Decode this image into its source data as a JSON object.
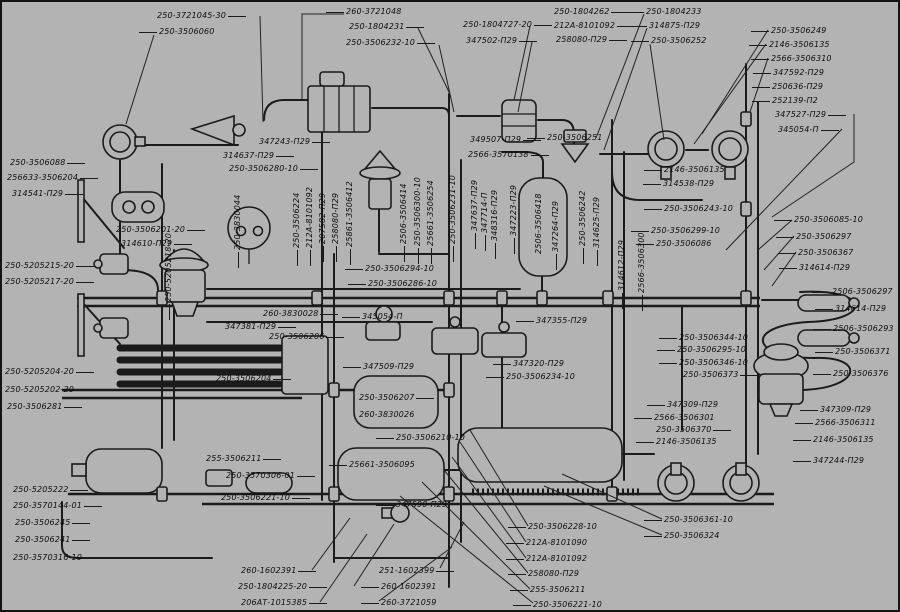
{
  "diagram": {
    "type": "pneumatic-brake-system-schematic",
    "background_color": "#b3b3b3",
    "line_color": "#1b1b1b",
    "label_color": "#0d0d0d"
  },
  "labels": [
    {
      "t": "250-3721045-30",
      "x": 155,
      "y": 9,
      "lead": "r"
    },
    {
      "t": "250-3506060",
      "x": 157,
      "y": 25,
      "lead": "l"
    },
    {
      "t": "260-3721048",
      "x": 344,
      "y": 5,
      "lead": "l"
    },
    {
      "t": "250-1804231",
      "x": 347,
      "y": 20,
      "lead": "r"
    },
    {
      "t": "250-3506232-10",
      "x": 344,
      "y": 36,
      "lead": "r"
    },
    {
      "t": "250-1804727-20",
      "x": 461,
      "y": 18,
      "lead": "r"
    },
    {
      "t": "347502-П29",
      "x": 464,
      "y": 34,
      "lead": "r"
    },
    {
      "t": "250-1804262",
      "x": 552,
      "y": 5,
      "lead": "r"
    },
    {
      "t": "212А-8101092",
      "x": 552,
      "y": 19,
      "lead": "r"
    },
    {
      "t": "258080-П29",
      "x": 554,
      "y": 33,
      "lead": "r"
    },
    {
      "t": "250-1804233",
      "x": 644,
      "y": 5,
      "lead": "l"
    },
    {
      "t": "314875-П29",
      "x": 647,
      "y": 19,
      "lead": "l"
    },
    {
      "t": "250-3506252",
      "x": 649,
      "y": 34,
      "lead": "l"
    },
    {
      "t": "250-3506249",
      "x": 769,
      "y": 24,
      "lead": "l"
    },
    {
      "t": "2146-3506135",
      "x": 767,
      "y": 38,
      "lead": "l"
    },
    {
      "t": "2566-3506310",
      "x": 769,
      "y": 52,
      "lead": "l"
    },
    {
      "t": "347592-П29",
      "x": 771,
      "y": 66,
      "lead": "l"
    },
    {
      "t": "250636-П29",
      "x": 770,
      "y": 80,
      "lead": "l"
    },
    {
      "t": "252139-П2",
      "x": 770,
      "y": 94,
      "lead": "l"
    },
    {
      "t": "347527-П29",
      "x": 773,
      "y": 108,
      "lead": "r"
    },
    {
      "t": "345054-П",
      "x": 776,
      "y": 123,
      "lead": "r"
    },
    {
      "t": "250-3506088",
      "x": 8,
      "y": 156,
      "lead": "r"
    },
    {
      "t": "256633-3506204",
      "x": 5,
      "y": 171,
      "lead": "r"
    },
    {
      "t": "314541-П29",
      "x": 10,
      "y": 187,
      "lead": "r"
    },
    {
      "t": "250-3506201-20",
      "x": 114,
      "y": 223,
      "lead": "r"
    },
    {
      "t": "314610-П29",
      "x": 119,
      "y": 237,
      "lead": "r"
    },
    {
      "t": "250-5205215-20",
      "x": 3,
      "y": 259,
      "lead": "r"
    },
    {
      "t": "250-5205217-20",
      "x": 3,
      "y": 275,
      "lead": "r"
    },
    {
      "t": "250-5205204-20",
      "x": 3,
      "y": 365,
      "lead": "r"
    },
    {
      "t": "250-5205202-20",
      "x": 3,
      "y": 383,
      "lead": "r"
    },
    {
      "t": "250-3506281",
      "x": 5,
      "y": 400,
      "lead": "r"
    },
    {
      "t": "250-5205222",
      "x": 11,
      "y": 483,
      "lead": "r"
    },
    {
      "t": "250-3570144-01",
      "x": 11,
      "y": 499,
      "lead": "r"
    },
    {
      "t": "250-3506245",
      "x": 13,
      "y": 516,
      "lead": "r"
    },
    {
      "t": "250-3506241",
      "x": 13,
      "y": 533,
      "lead": "r"
    },
    {
      "t": "250-3570316-10",
      "x": 11,
      "y": 551,
      "lead": "r"
    },
    {
      "t": "347243-П29",
      "x": 257,
      "y": 135,
      "lead": "r"
    },
    {
      "t": "314637-П29",
      "x": 221,
      "y": 149,
      "lead": "r"
    },
    {
      "t": "250-3506280-10",
      "x": 227,
      "y": 162,
      "lead": "r"
    },
    {
      "t": "349507-П29",
      "x": 468,
      "y": 133,
      "lead": "r"
    },
    {
      "t": "2566-3570138",
      "x": 466,
      "y": 148,
      "lead": "r"
    },
    {
      "t": "250-3506251",
      "x": 545,
      "y": 131,
      "lead": "l"
    },
    {
      "t": "250-3506294-10",
      "x": 363,
      "y": 262,
      "lead": "l"
    },
    {
      "t": "250-3506286-10",
      "x": 366,
      "y": 277,
      "lead": "l"
    },
    {
      "t": "260-3830028",
      "x": 261,
      "y": 307,
      "lead": "r"
    },
    {
      "t": "347381-П29",
      "x": 223,
      "y": 320,
      "lead": "r"
    },
    {
      "t": "250-3506206",
      "x": 267,
      "y": 330,
      "lead": "r"
    },
    {
      "t": "250-3506204",
      "x": 214,
      "y": 372,
      "lead": "r"
    },
    {
      "t": "345054-П",
      "x": 360,
      "y": 310,
      "lead": "l"
    },
    {
      "t": "347509-П29",
      "x": 361,
      "y": 360,
      "lead": "l"
    },
    {
      "t": "250-3506207",
      "x": 357,
      "y": 391,
      "lead": "r"
    },
    {
      "t": "260-3830026",
      "x": 357,
      "y": 408,
      "lead": "n"
    },
    {
      "t": "250-3506210-10",
      "x": 394,
      "y": 431,
      "lead": "l"
    },
    {
      "t": "347355-П29",
      "x": 534,
      "y": 314,
      "lead": "l"
    },
    {
      "t": "347320-П29",
      "x": 511,
      "y": 357,
      "lead": "l"
    },
    {
      "t": "250-3506234-10",
      "x": 504,
      "y": 370,
      "lead": "l"
    },
    {
      "t": "2146-3506135",
      "x": 662,
      "y": 163,
      "lead": "l"
    },
    {
      "t": "314538-П29",
      "x": 661,
      "y": 177,
      "lead": "l"
    },
    {
      "t": "250-3506243-10",
      "x": 662,
      "y": 202,
      "lead": "l"
    },
    {
      "t": "250-3506299-10",
      "x": 649,
      "y": 224,
      "lead": "l"
    },
    {
      "t": "250-3506086",
      "x": 654,
      "y": 237,
      "lead": "l"
    },
    {
      "t": "250-3506085-10",
      "x": 792,
      "y": 213,
      "lead": "l"
    },
    {
      "t": "250-3506297",
      "x": 794,
      "y": 230,
      "lead": "l"
    },
    {
      "t": "250-3506367",
      "x": 796,
      "y": 246,
      "lead": "l"
    },
    {
      "t": "314614-П29",
      "x": 797,
      "y": 261,
      "lead": "l"
    },
    {
      "t": "2506-3506297",
      "x": 830,
      "y": 285,
      "lead": "l"
    },
    {
      "t": "314614-П29",
      "x": 833,
      "y": 302,
      "lead": "l"
    },
    {
      "t": "2506-3506293",
      "x": 831,
      "y": 322,
      "lead": "l"
    },
    {
      "t": "250-3506371",
      "x": 833,
      "y": 345,
      "lead": "l"
    },
    {
      "t": "250-3506376",
      "x": 831,
      "y": 367,
      "lead": "l"
    },
    {
      "t": "347309-П29",
      "x": 818,
      "y": 403,
      "lead": "l"
    },
    {
      "t": "2566-3506311",
      "x": 813,
      "y": 416,
      "lead": "l"
    },
    {
      "t": "2146-3506135",
      "x": 811,
      "y": 433,
      "lead": "l"
    },
    {
      "t": "347244-П29",
      "x": 811,
      "y": 454,
      "lead": "l"
    },
    {
      "t": "250-3506344-10",
      "x": 677,
      "y": 331,
      "lead": "l"
    },
    {
      "t": "250-3506295-10",
      "x": 675,
      "y": 343,
      "lead": "l"
    },
    {
      "t": "250-3506346-10",
      "x": 677,
      "y": 356,
      "lead": "l"
    },
    {
      "t": "250-3506373",
      "x": 681,
      "y": 368,
      "lead": "r"
    },
    {
      "t": "347309-П29",
      "x": 665,
      "y": 398,
      "lead": "l"
    },
    {
      "t": "2566-3506301",
      "x": 652,
      "y": 411,
      "lead": "l"
    },
    {
      "t": "250-3506370",
      "x": 654,
      "y": 423,
      "lead": "r"
    },
    {
      "t": "2146-3506135",
      "x": 654,
      "y": 435,
      "lead": "l"
    },
    {
      "t": "255-3506211",
      "x": 204,
      "y": 452,
      "lead": "r"
    },
    {
      "t": "250-3570306-01",
      "x": 224,
      "y": 469,
      "lead": "r"
    },
    {
      "t": "250-3506221-10",
      "x": 219,
      "y": 491,
      "lead": "r"
    },
    {
      "t": "25661-3506095",
      "x": 347,
      "y": 458,
      "lead": "l"
    },
    {
      "t": "347590-П29",
      "x": 394,
      "y": 498,
      "lead": "l"
    },
    {
      "t": "260-1602391",
      "x": 239,
      "y": 564,
      "lead": "r"
    },
    {
      "t": "250-1804225-20",
      "x": 236,
      "y": 580,
      "lead": "r"
    },
    {
      "t": "206АТ-1015385",
      "x": 239,
      "y": 596,
      "lead": "r"
    },
    {
      "t": "251-1602399",
      "x": 377,
      "y": 564,
      "lead": "r"
    },
    {
      "t": "260-1602391",
      "x": 379,
      "y": 580,
      "lead": "l"
    },
    {
      "t": "260-3721059",
      "x": 379,
      "y": 596,
      "lead": "l"
    },
    {
      "t": "250-3506228-10",
      "x": 526,
      "y": 520,
      "lead": "l"
    },
    {
      "t": "212А-8101090",
      "x": 524,
      "y": 536,
      "lead": "l"
    },
    {
      "t": "212А-8101092",
      "x": 524,
      "y": 552,
      "lead": "l"
    },
    {
      "t": "258080-П29",
      "x": 526,
      "y": 567,
      "lead": "l"
    },
    {
      "t": "255-3506211",
      "x": 528,
      "y": 583,
      "lead": "l"
    },
    {
      "t": "250-3506221-10",
      "x": 531,
      "y": 598,
      "lead": "l"
    },
    {
      "t": "250-3506361-10",
      "x": 662,
      "y": 513,
      "lead": "l"
    },
    {
      "t": "250-3506324",
      "x": 662,
      "y": 529,
      "lead": "l"
    },
    {
      "t": "250-5205218-20",
      "x": 162,
      "y": 300,
      "rot": true,
      "lead": "d"
    },
    {
      "t": "250-3830044",
      "x": 231,
      "y": 248,
      "rot": true,
      "lead": "d"
    },
    {
      "t": "250-3506224",
      "x": 290,
      "y": 246,
      "rot": true,
      "lead": "d"
    },
    {
      "t": "212А-8101092",
      "x": 303,
      "y": 246,
      "rot": true,
      "lead": "d"
    },
    {
      "t": "207582-П29",
      "x": 316,
      "y": 242,
      "rot": true,
      "lead": "d"
    },
    {
      "t": "258080-П29",
      "x": 329,
      "y": 242,
      "rot": true,
      "lead": "d"
    },
    {
      "t": "25861-3506412",
      "x": 343,
      "y": 245,
      "rot": true,
      "lead": "d"
    },
    {
      "t": "2506-3506414",
      "x": 397,
      "y": 242,
      "rot": true,
      "lead": "d"
    },
    {
      "t": "250-3506300-10",
      "x": 411,
      "y": 244,
      "rot": true,
      "lead": "d"
    },
    {
      "t": "25661-3506254",
      "x": 424,
      "y": 244,
      "rot": true,
      "lead": "d"
    },
    {
      "t": "250-3506231-10",
      "x": 446,
      "y": 242,
      "rot": true,
      "lead": "d"
    },
    {
      "t": "347637-П29",
      "x": 468,
      "y": 229,
      "rot": true,
      "lead": "d"
    },
    {
      "t": "347714-П",
      "x": 478,
      "y": 231,
      "rot": true,
      "lead": "d"
    },
    {
      "t": "348316-П29",
      "x": 488,
      "y": 239,
      "rot": true,
      "lead": "d"
    },
    {
      "t": "347223-П29",
      "x": 507,
      "y": 234,
      "rot": true,
      "lead": "d"
    },
    {
      "t": "2506-3506418",
      "x": 532,
      "y": 252,
      "rot": true,
      "lead": "n"
    },
    {
      "t": "347264-П29",
      "x": 549,
      "y": 250,
      "rot": true,
      "lead": "d"
    },
    {
      "t": "250-3506242",
      "x": 576,
      "y": 244,
      "rot": true,
      "lead": "d"
    },
    {
      "t": "314625-П29",
      "x": 590,
      "y": 246,
      "rot": true,
      "lead": "d"
    },
    {
      "t": "314612-П29",
      "x": 615,
      "y": 289,
      "rot": true,
      "lead": "d"
    },
    {
      "t": "2566-3506300",
      "x": 635,
      "y": 291,
      "rot": true,
      "lead": "d"
    }
  ]
}
